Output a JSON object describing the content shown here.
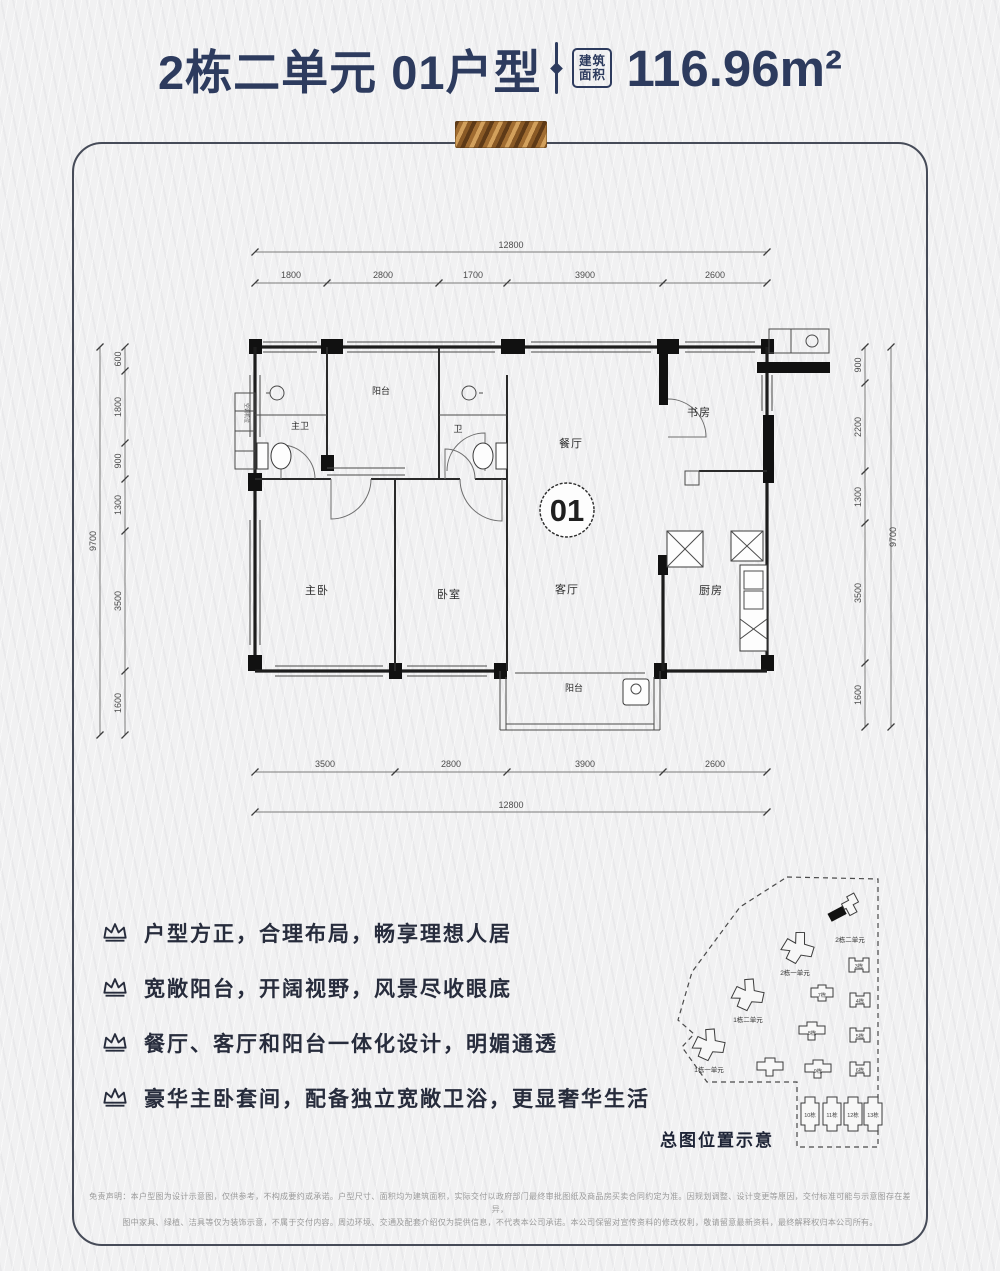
{
  "header": {
    "title": "2栋二单元 01户型",
    "area_badge_line1": "建筑",
    "area_badge_line2": "面积",
    "area_value": "116.96m²"
  },
  "plan": {
    "top_total": "12800",
    "top": [
      "1800",
      "2800",
      "1700",
      "3900",
      "2600"
    ],
    "bottom": [
      "3500",
      "2800",
      "3900",
      "2600"
    ],
    "bottom_total": "12800",
    "left": [
      "600",
      "1800",
      "900",
      "1300",
      "3500",
      "1600"
    ],
    "left_total": "9700",
    "right": [
      "900",
      "2200",
      "1300",
      "3500",
      "1600"
    ],
    "right_total": "9700",
    "rooms": {
      "master_bath": "主卫",
      "top_balcony": "阳台",
      "bath": "卫",
      "dining": "餐厅",
      "study": "书房",
      "unit_number": "01",
      "master_bedroom": "主卧",
      "bedroom": "卧室",
      "living": "客厅",
      "kitchen": "厨房",
      "balcony": "阳台",
      "ac_platform": "空调机位"
    }
  },
  "features": [
    "户型方正，合理布局，畅享理想人居",
    "宽敞阳台，开阔视野，风景尽收眼底",
    "餐厅、客厅和阳台一体化设计，明媚通透",
    "豪华主卧套间，配备独立宽敞卫浴，更显奢华生活"
  ],
  "siteplan": {
    "caption": "总图位置示意",
    "highlight_label": "2栋二单元",
    "label_top_mid": "2栋一单元",
    "label_mid_left": "1栋二单元",
    "label_low_left": "1栋一单元",
    "numbers": [
      "3栋",
      "4栋",
      "5栋",
      "6栋",
      "7栋",
      "8栋",
      "9栋",
      "10栋",
      "11栋",
      "12栋",
      "13栋"
    ]
  },
  "disclaimer": {
    "line1": "免责声明：本户型图为设计示意图，仅供参考，不构成要约或承诺。户型尺寸、面积均为建筑面积，实际交付以政府部门最终审批图纸及商品房买卖合同约定为准。因规划调整、设计变更等原因，交付标准可能与示意图存在差异，",
    "line2": "图中家具、绿植、洁具等仅为装饰示意，不属于交付内容。周边环境、交通及配套介绍仅为提供信息，不代表本公司承诺。本公司保留对宣传资料的修改权利，敬请留意最新资料，最终解释权归本公司所有。"
  }
}
